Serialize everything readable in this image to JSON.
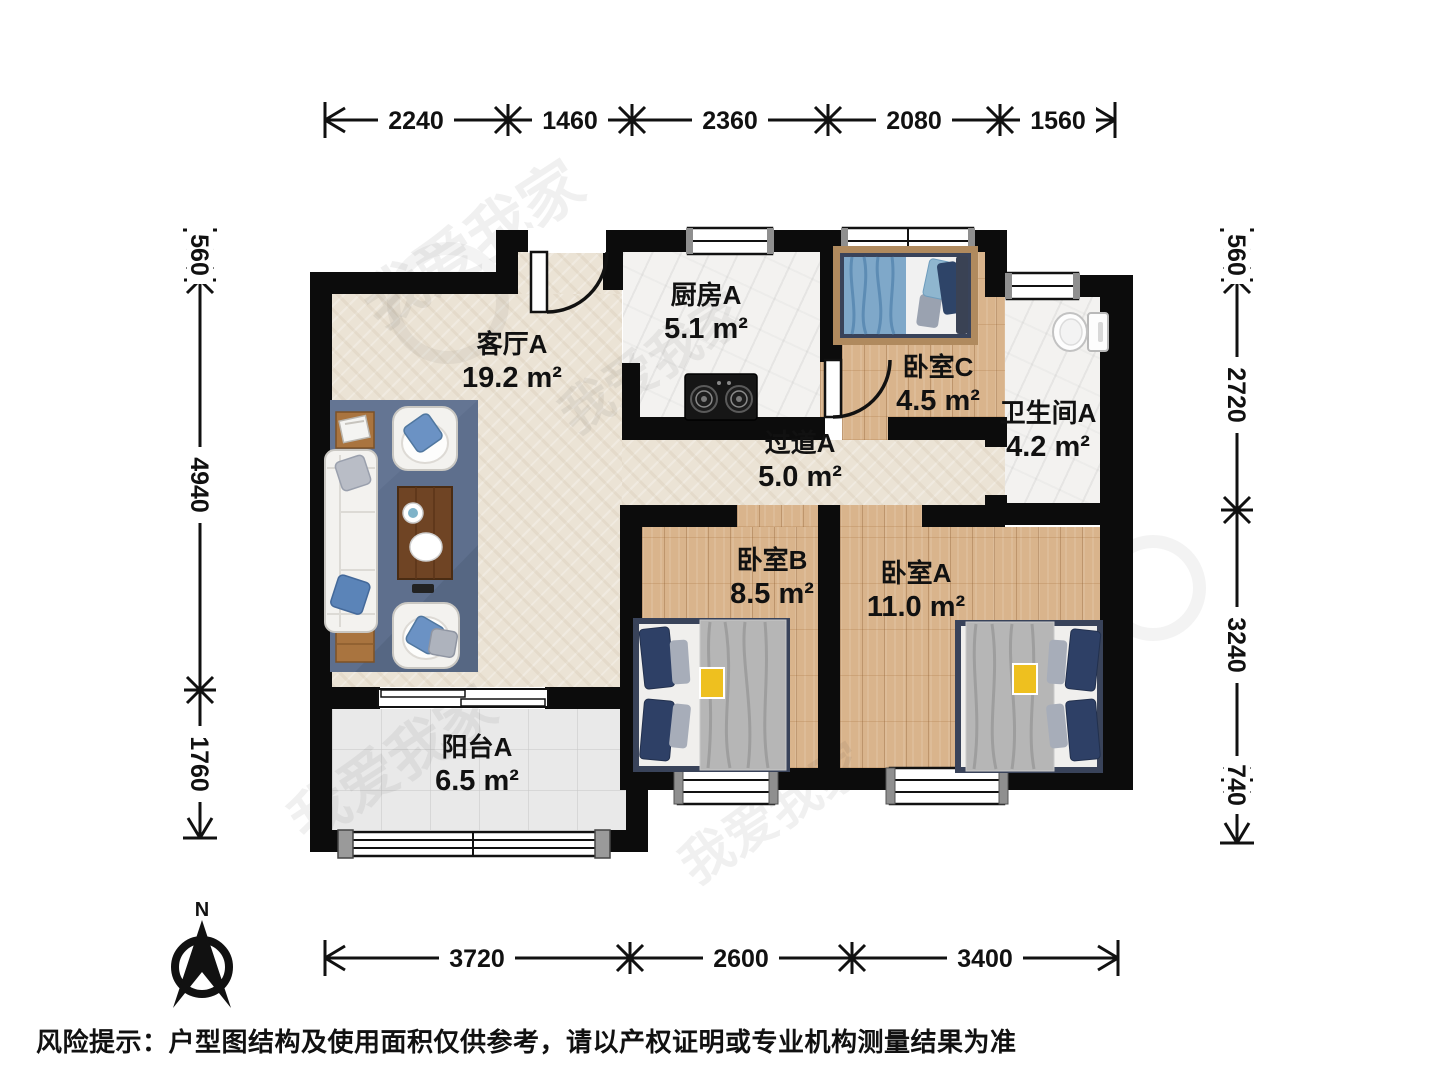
{
  "rooms": {
    "living": {
      "name": "客厅A",
      "area": "19.2 m²"
    },
    "kitchen": {
      "name": "厨房A",
      "area": "5.1 m²"
    },
    "bedroom_c": {
      "name": "卧室C",
      "area": "4.5 m²"
    },
    "bathroom": {
      "name": "卫生间A",
      "area": "4.2 m²"
    },
    "hallway": {
      "name": "过道A",
      "area": "5.0 m²"
    },
    "bedroom_b": {
      "name": "卧室B",
      "area": "8.5 m²"
    },
    "bedroom_a": {
      "name": "卧室A",
      "area": "11.0 m²"
    },
    "balcony": {
      "name": "阳台A",
      "area": "6.5 m²"
    }
  },
  "dimensions_mm": {
    "top": [
      "2240",
      "1460",
      "2360",
      "2080",
      "1560"
    ],
    "bottom": [
      "3720",
      "2600",
      "3400"
    ],
    "left": [
      "560",
      "4940",
      "1760"
    ],
    "right": [
      "560",
      "2720",
      "3240",
      "740"
    ]
  },
  "compass": {
    "label": "N"
  },
  "watermark": {
    "brand": "我爱我家"
  },
  "disclaimer": "风险提示：户型图结构及使用面积仅供参考，请以产权证明或专业机构测量结果为准",
  "colors": {
    "wall": "#0c0c0c",
    "wood_floor": "#d9b48c",
    "beige_floor": "#ebe3d5",
    "rug": "#5e6f8d",
    "accent_bed": "#39435a"
  }
}
